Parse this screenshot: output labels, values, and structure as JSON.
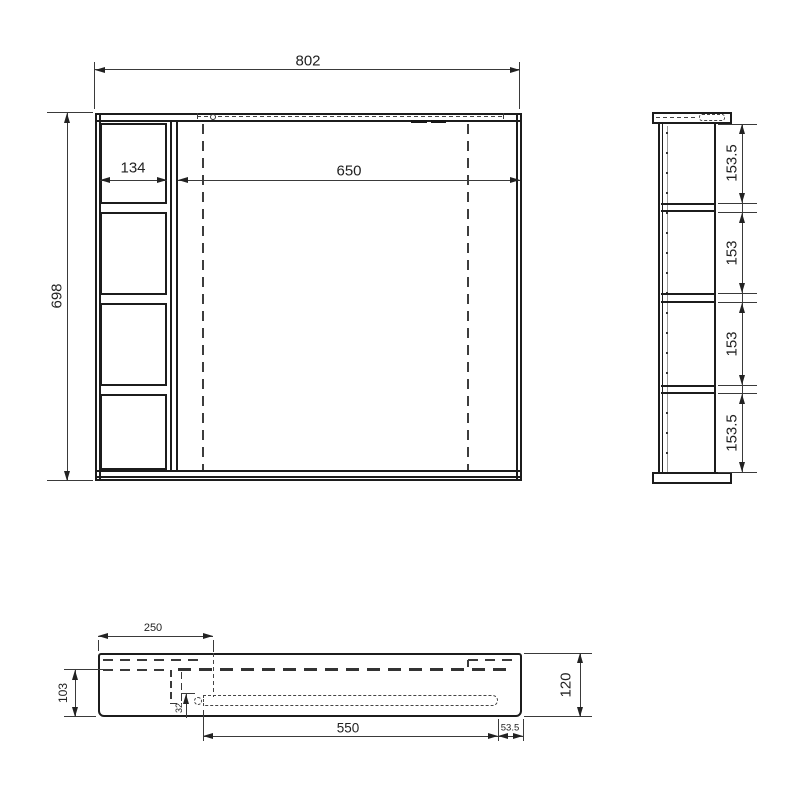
{
  "drawing": {
    "type": "cad-orthographic-views",
    "line_color": "#1c1c1c",
    "background": "#ffffff",
    "front_view": {
      "width": "802",
      "height": "698",
      "shelf_width": "134",
      "opening_width": "650"
    },
    "side_view": {
      "sections": [
        "153.5",
        "153",
        "153",
        "153.5"
      ]
    },
    "bottom_view": {
      "top_offset": "250",
      "back_depth": "103",
      "bracket_depth": "32",
      "slot_length": "550",
      "right_inset": "53.5",
      "total_depth": "120"
    }
  }
}
